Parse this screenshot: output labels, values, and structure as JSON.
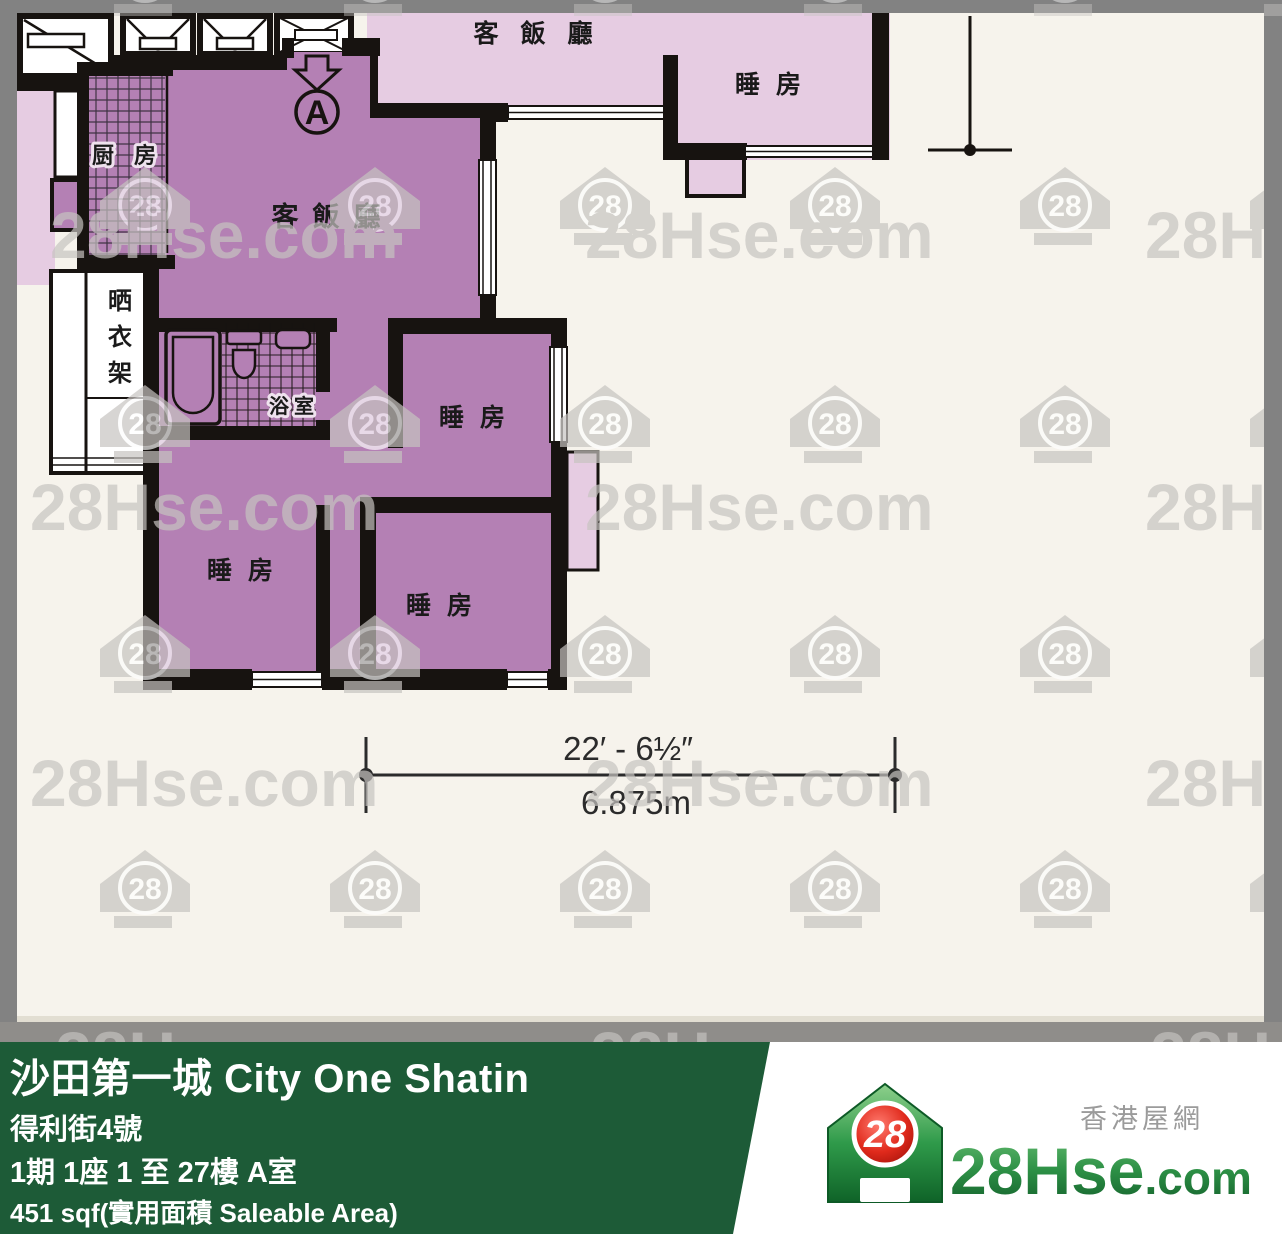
{
  "plan": {
    "unit": {
      "marker": "A",
      "living_dining": "客飯廳",
      "kitchen": "厨房",
      "bathroom": "浴室",
      "bedroom": "睡房"
    },
    "neighbor": {
      "living_dining": "客飯廳",
      "bedroom": "睡房",
      "drying_rack": "晒衣架"
    },
    "dimension": {
      "imperial": "22′ - 6½″",
      "metric": "6.875m"
    }
  },
  "watermark": {
    "brand": "28Hse.com",
    "badge": "28"
  },
  "banner": {
    "title": "沙田第一城 City One Shatin",
    "address": "得利街4號",
    "phase_info": "1期 1座 1 至 27樓 A室",
    "area": "451 sqf(實用面積 Saleable Area)"
  },
  "logo": {
    "badge": "28",
    "brand": "28Hse",
    "suffix": ".com",
    "tagline": "香港屋網"
  },
  "colors": {
    "unit_fill": "#b480b4",
    "neighbor_fill": "#e6cce2",
    "wall": "#171310",
    "paper": "#f6f3ec",
    "frame_gray": "#828282",
    "band_gray": "#8f8d8a",
    "banner_green": "#1d5b37",
    "logo_red": "#d92015"
  }
}
